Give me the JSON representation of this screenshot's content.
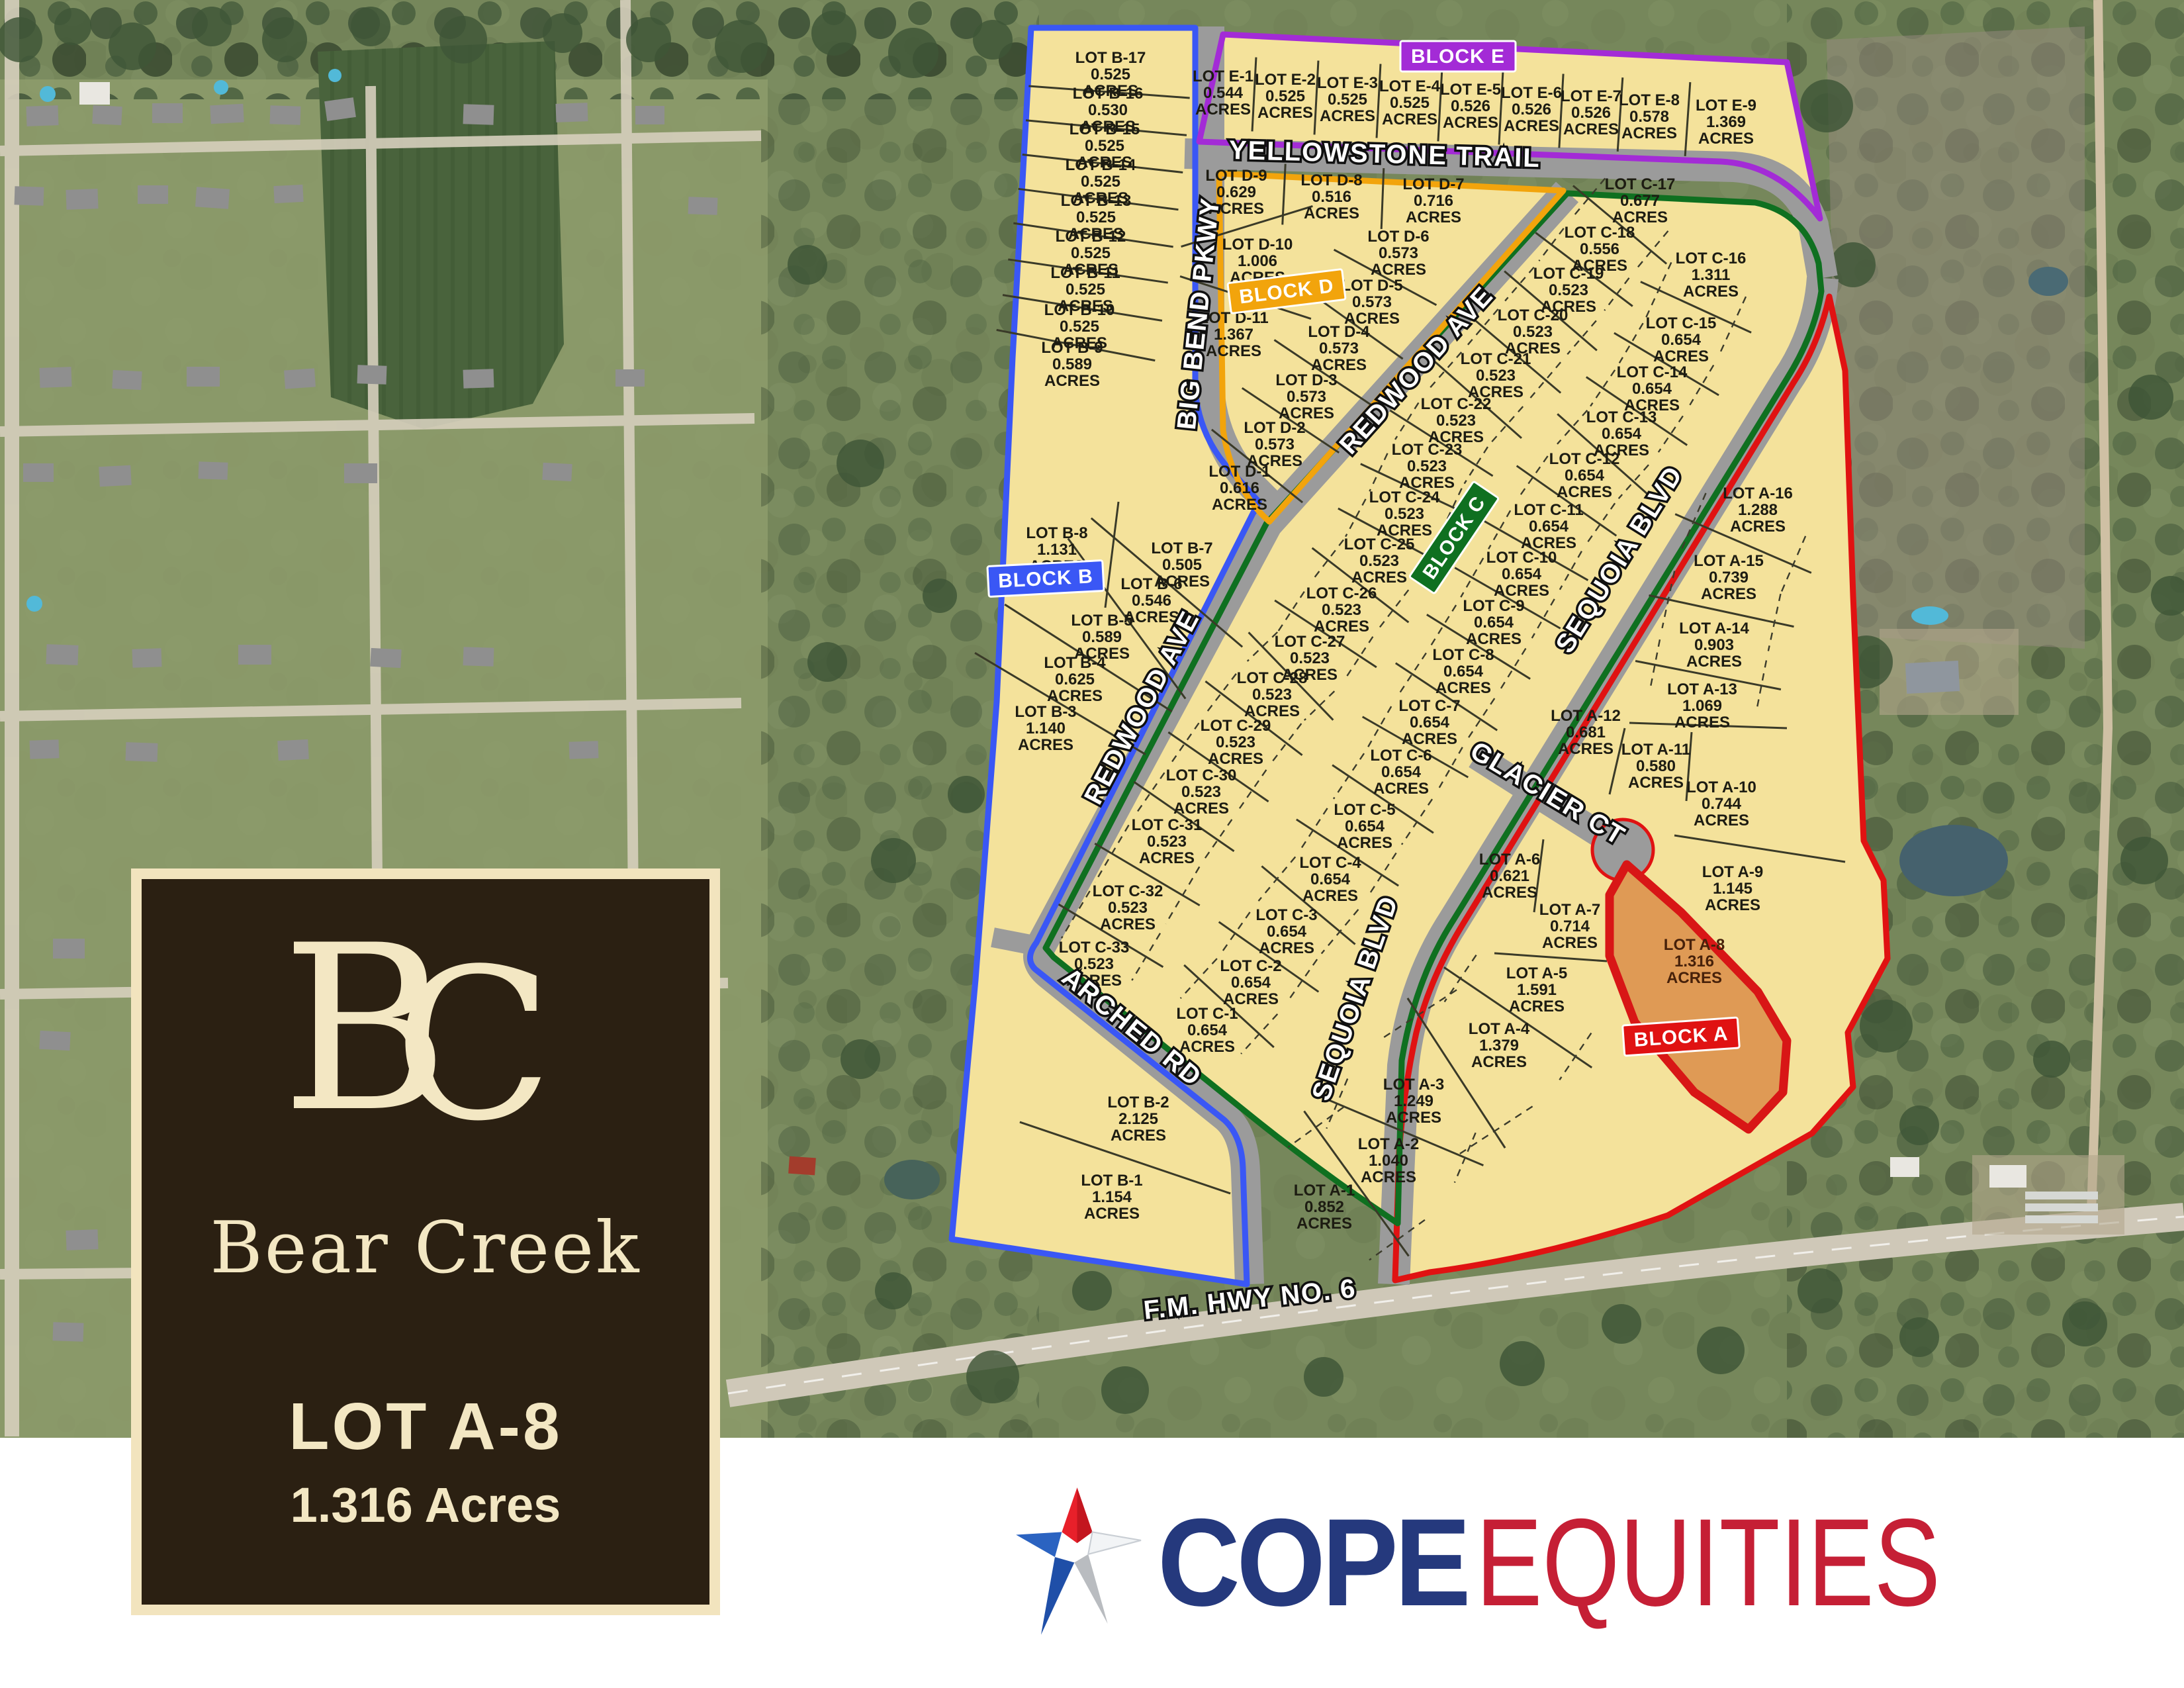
{
  "title_panel": {
    "monogram_b": "B",
    "monogram_c": "C",
    "community": "Bear Creek",
    "lot_title": "LOT A-8",
    "lot_acres": "1.316 Acres",
    "panel_bg": "#2b2012",
    "frame_color": "#f2e4be",
    "text_color": "#f3e7c3"
  },
  "branding": {
    "word_primary": "COPE",
    "word_secondary": "EQUITIES",
    "primary_color": "#25397d",
    "secondary_color": "#c51f35",
    "star_icon": "star-icon"
  },
  "map": {
    "lot_label_prefix": "LOT",
    "lot_label_suffix": "ACRES",
    "highway_label": "F.M. HWY NO. 6",
    "streets": [
      "YELLOWSTONE TRAIL",
      "BIG BEND PKWY",
      "REDWOOD AVE",
      "SEQUOIA BLVD",
      "GLACIER CT",
      "ARCHED RD"
    ],
    "highlight": {
      "lot_id": "A-8",
      "fill": "#df9a55",
      "outline": "#d81616"
    },
    "colors": {
      "lot_fill": "#f4e29b",
      "road": "#9b9b9b"
    },
    "blocks": [
      {
        "name": "BLOCK A",
        "color": "#e01212",
        "lots": [
          {
            "id": "A-1",
            "acres": "0.852"
          },
          {
            "id": "A-2",
            "acres": "1.040"
          },
          {
            "id": "A-3",
            "acres": "1.249"
          },
          {
            "id": "A-4",
            "acres": "1.379"
          },
          {
            "id": "A-5",
            "acres": "1.591"
          },
          {
            "id": "A-6",
            "acres": "0.621"
          },
          {
            "id": "A-7",
            "acres": "0.714"
          },
          {
            "id": "A-8",
            "acres": "1.316"
          },
          {
            "id": "A-9",
            "acres": "1.145"
          },
          {
            "id": "A-10",
            "acres": "0.744"
          },
          {
            "id": "A-11",
            "acres": "0.580"
          },
          {
            "id": "A-12",
            "acres": "0.681"
          },
          {
            "id": "A-13",
            "acres": "1.069"
          },
          {
            "id": "A-14",
            "acres": "0.903"
          },
          {
            "id": "A-15",
            "acres": "0.739"
          },
          {
            "id": "A-16",
            "acres": "1.288"
          }
        ]
      },
      {
        "name": "BLOCK B",
        "color": "#3a57f5",
        "lots": [
          {
            "id": "B-1",
            "acres": "1.154"
          },
          {
            "id": "B-2",
            "acres": "2.125"
          },
          {
            "id": "B-3",
            "acres": "1.140"
          },
          {
            "id": "B-4",
            "acres": "0.625"
          },
          {
            "id": "B-5",
            "acres": "0.589"
          },
          {
            "id": "B-6",
            "acres": "0.546"
          },
          {
            "id": "B-7",
            "acres": "0.505"
          },
          {
            "id": "B-8",
            "acres": "1.131"
          },
          {
            "id": "B-9",
            "acres": "0.589"
          },
          {
            "id": "B-10",
            "acres": "0.525"
          },
          {
            "id": "B-11",
            "acres": "0.525"
          },
          {
            "id": "B-12",
            "acres": "0.525"
          },
          {
            "id": "B-13",
            "acres": "0.525"
          },
          {
            "id": "B-14",
            "acres": "0.525"
          },
          {
            "id": "B-15",
            "acres": "0.525"
          },
          {
            "id": "B-16",
            "acres": "0.530"
          },
          {
            "id": "B-17",
            "acres": "0.525"
          }
        ]
      },
      {
        "name": "BLOCK C",
        "color": "#0f7020",
        "lots": [
          {
            "id": "C-1",
            "acres": "0.654"
          },
          {
            "id": "C-2",
            "acres": "0.654"
          },
          {
            "id": "C-3",
            "acres": "0.654"
          },
          {
            "id": "C-4",
            "acres": "0.654"
          },
          {
            "id": "C-5",
            "acres": "0.654"
          },
          {
            "id": "C-6",
            "acres": "0.654"
          },
          {
            "id": "C-7",
            "acres": "0.654"
          },
          {
            "id": "C-8",
            "acres": "0.654"
          },
          {
            "id": "C-9",
            "acres": "0.654"
          },
          {
            "id": "C-10",
            "acres": "0.654"
          },
          {
            "id": "C-11",
            "acres": "0.654"
          },
          {
            "id": "C-12",
            "acres": "0.654"
          },
          {
            "id": "C-13",
            "acres": "0.654"
          },
          {
            "id": "C-14",
            "acres": "0.654"
          },
          {
            "id": "C-15",
            "acres": "0.654"
          },
          {
            "id": "C-16",
            "acres": "1.311"
          },
          {
            "id": "C-17",
            "acres": "0.677"
          },
          {
            "id": "C-18",
            "acres": "0.556"
          },
          {
            "id": "C-19",
            "acres": "0.523"
          },
          {
            "id": "C-20",
            "acres": "0.523"
          },
          {
            "id": "C-21",
            "acres": "0.523"
          },
          {
            "id": "C-22",
            "acres": "0.523"
          },
          {
            "id": "C-23",
            "acres": "0.523"
          },
          {
            "id": "C-24",
            "acres": "0.523"
          },
          {
            "id": "C-25",
            "acres": "0.523"
          },
          {
            "id": "C-26",
            "acres": "0.523"
          },
          {
            "id": "C-27",
            "acres": "0.523"
          },
          {
            "id": "C-28",
            "acres": "0.523"
          },
          {
            "id": "C-29",
            "acres": "0.523"
          },
          {
            "id": "C-30",
            "acres": "0.523"
          },
          {
            "id": "C-31",
            "acres": "0.523"
          },
          {
            "id": "C-32",
            "acres": "0.523"
          },
          {
            "id": "C-33",
            "acres": "0.523"
          }
        ]
      },
      {
        "name": "BLOCK D",
        "color": "#f2a40c",
        "lots": [
          {
            "id": "D-1",
            "acres": "0.616"
          },
          {
            "id": "D-2",
            "acres": "0.573"
          },
          {
            "id": "D-3",
            "acres": "0.573"
          },
          {
            "id": "D-4",
            "acres": "0.573"
          },
          {
            "id": "D-5",
            "acres": "0.573"
          },
          {
            "id": "D-6",
            "acres": "0.573"
          },
          {
            "id": "D-7",
            "acres": "0.716"
          },
          {
            "id": "D-8",
            "acres": "0.516"
          },
          {
            "id": "D-9",
            "acres": "0.629"
          },
          {
            "id": "D-10",
            "acres": "1.006"
          },
          {
            "id": "D-11",
            "acres": "1.367"
          }
        ]
      },
      {
        "name": "BLOCK E",
        "color": "#a32bd6",
        "lots": [
          {
            "id": "E-1",
            "acres": "0.544"
          },
          {
            "id": "E-2",
            "acres": "0.525"
          },
          {
            "id": "E-3",
            "acres": "0.525"
          },
          {
            "id": "E-4",
            "acres": "0.525"
          },
          {
            "id": "E-5",
            "acres": "0.526"
          },
          {
            "id": "E-6",
            "acres": "0.526"
          },
          {
            "id": "E-7",
            "acres": "0.526"
          },
          {
            "id": "E-8",
            "acres": "0.578"
          },
          {
            "id": "E-9",
            "acres": "1.369"
          }
        ]
      }
    ]
  }
}
